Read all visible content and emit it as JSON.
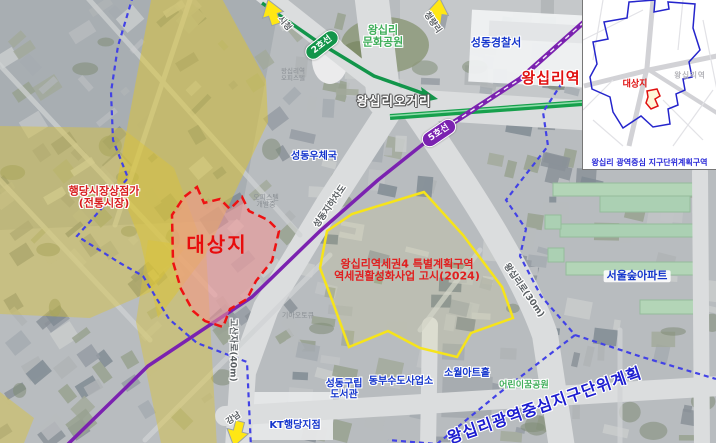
{
  "keymap": {
    "title": "KEY MAP",
    "site_label": "대상지",
    "station_label": "왕십리역",
    "caption": "왕십리 광역중심 지구단위계획구역"
  },
  "arrows": {
    "city_hall": "시청",
    "cheongnyangni": "청량리",
    "gangnam": "강남"
  },
  "subway": {
    "line2_badge": "2호선",
    "line2_color": "#12954a",
    "line5_badge": "5호선",
    "line5_color": "#7b22b0"
  },
  "site": {
    "label": "대상지",
    "outline_color": "#ee1212"
  },
  "market": {
    "line1": "행당시장상점가",
    "line2": "(전통시장)",
    "zone_color": "#d9c33a"
  },
  "special_zone": {
    "line1": "왕십리역세권4 특별계획구역",
    "line2": "역세권활성화사업 고시(2024)",
    "outline_color": "#f6e41a"
  },
  "roads": {
    "underpass": "성동지하차도",
    "wangsimni_ro": "왕십리로(30m)",
    "gosanja_ro": "고산자로(40m)"
  },
  "places": {
    "station": "왕십리역",
    "intersection": "왕십리오거리",
    "police": "성동경찰서",
    "culture_park_line1": "왕십리",
    "culture_park_line2": "문화공원",
    "post_office": "성동우체국",
    "officetel_line1": "왕십리역",
    "officetel_line2": "오피스텔",
    "officetel_dev_line1": "오피스텔",
    "officetel_dev_line2": "개발중",
    "kia": "기아오토큐",
    "seoul_forest_apt": "서울숲아파트",
    "sowol_art_hall": "소월아트홀",
    "children_park": "어린이꿈공원",
    "library_line1": "성동구립",
    "library_line2": "도서관",
    "water_office": "동부수도사업소",
    "kt": "KT행당지점",
    "district_plan": "왕십리광역중심지구단위계획",
    "boundary_color": "#4242e6"
  }
}
